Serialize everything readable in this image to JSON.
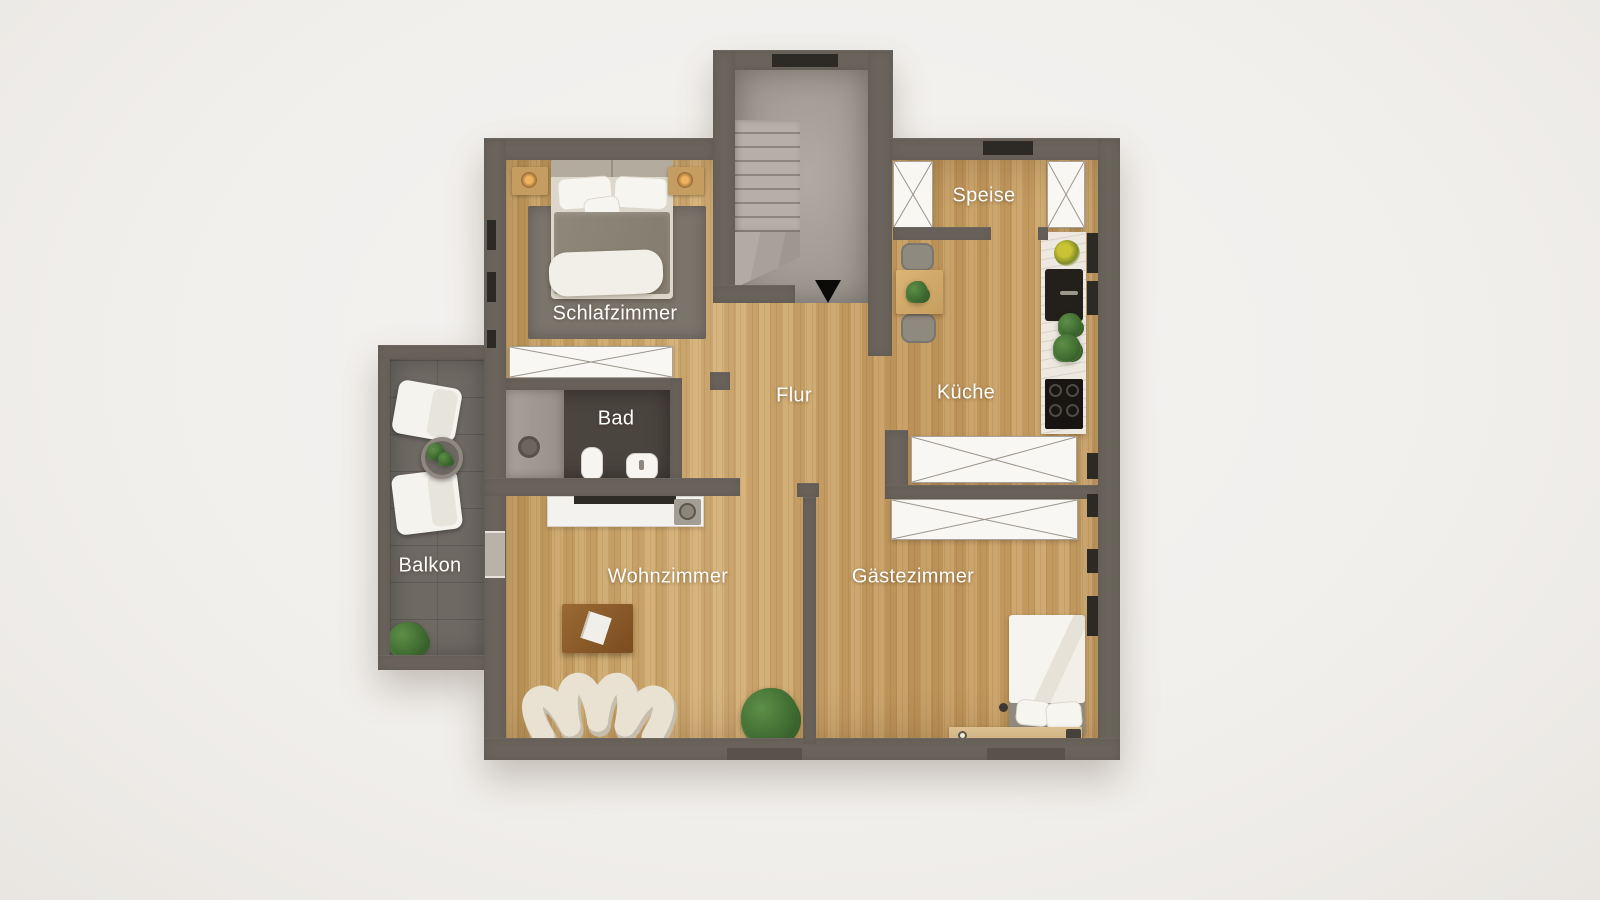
{
  "rooms": [
    {
      "id": "schlafzimmer",
      "label": "Schlafzimmer"
    },
    {
      "id": "bad",
      "label": "Bad"
    },
    {
      "id": "flur",
      "label": "Flur"
    },
    {
      "id": "speise",
      "label": "Speise"
    },
    {
      "id": "kueche",
      "label": "Küche"
    },
    {
      "id": "balkon",
      "label": "Balkon"
    },
    {
      "id": "wohnzimmer",
      "label": "Wohnzimmer"
    },
    {
      "id": "gaestezimmer",
      "label": "Gästezimmer"
    }
  ],
  "stairwell": {
    "direction_arrow": "down"
  },
  "furniture": {
    "schlafzimmer": [
      "double-bed",
      "nightstand",
      "nightstand",
      "bedside-lamp",
      "bedside-lamp",
      "rug",
      "wardrobe"
    ],
    "bad": [
      "shower",
      "toilet",
      "washbasin"
    ],
    "speise": [
      "wardrobe",
      "wardrobe",
      "desk-chair"
    ],
    "kueche": [
      "dining-table",
      "chair",
      "chair",
      "kitchen-counter",
      "fruit-bowl",
      "sink",
      "plants",
      "cooktop",
      "wardrobe"
    ],
    "wohnzimmer": [
      "sideboard",
      "tv",
      "record-player",
      "coffee-table",
      "modular-sofa",
      "plant"
    ],
    "gaestezimmer": [
      "wardrobe",
      "single-bed",
      "desk",
      "bedside-lamp"
    ],
    "balkon": [
      "lounge-chair",
      "lounge-chair",
      "side-table",
      "plant",
      "plant"
    ],
    "stairwell": [
      "staircase",
      "down-arrow"
    ]
  },
  "colors": {
    "background": "#f2f0ed",
    "wall": "#6b645c",
    "wood_floor": "#c9a469",
    "concrete_floor": "#a39c95",
    "balcony_floor": "#6e6963",
    "bathroom_floor": "#4b453f",
    "label_text": "#ffffff",
    "wardrobe_white": "#f8f7f4",
    "sofa_cream": "#e9e2d3",
    "plant_green": "#3f6b31",
    "appliance_black": "#1c1916"
  }
}
